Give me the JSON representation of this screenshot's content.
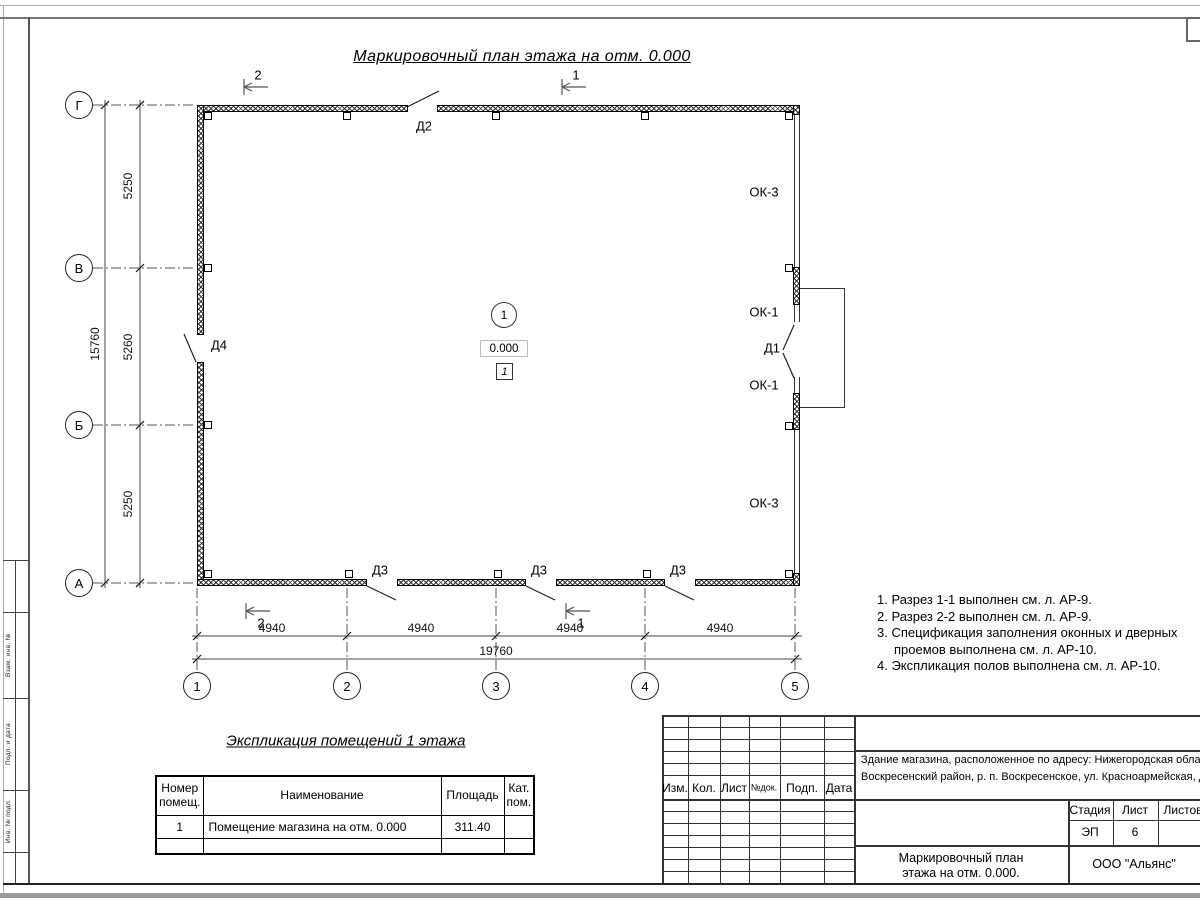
{
  "sheet": {
    "title": "Маркировочный план этажа на отм. 0.000"
  },
  "plan": {
    "axes_left": [
      {
        "label": "Г",
        "y": 105
      },
      {
        "label": "В",
        "y": 268
      },
      {
        "label": "Б",
        "y": 425
      },
      {
        "label": "А",
        "y": 583
      }
    ],
    "axes_bottom": [
      {
        "label": "1",
        "x": 197
      },
      {
        "label": "2",
        "x": 347
      },
      {
        "label": "3",
        "x": 496
      },
      {
        "label": "4",
        "x": 645
      },
      {
        "label": "5",
        "x": 795
      }
    ],
    "dims_left": [
      {
        "text": "5250",
        "y": 186
      },
      {
        "text": "5260",
        "y": 347
      },
      {
        "text": "5250",
        "y": 504
      }
    ],
    "dim_left_total": {
      "text": "15760",
      "y": 344
    },
    "dims_bottom": [
      {
        "text": "4940",
        "x": 272
      },
      {
        "text": "4940",
        "x": 421
      },
      {
        "text": "4940",
        "x": 570
      },
      {
        "text": "4940",
        "x": 720
      }
    ],
    "dim_bottom_total": {
      "text": "19760",
      "x": 496
    },
    "door_labels": [
      {
        "text": "Д2",
        "x": 424,
        "y": 126
      },
      {
        "text": "Д4",
        "x": 219,
        "y": 345
      },
      {
        "text": "Д1",
        "x": 772,
        "y": 348
      },
      {
        "text": "Д3",
        "x": 380,
        "y": 570
      },
      {
        "text": "Д3",
        "x": 539,
        "y": 570
      },
      {
        "text": "Д3",
        "x": 678,
        "y": 570
      }
    ],
    "window_labels": [
      {
        "text": "ОК-3",
        "x": 764,
        "y": 192
      },
      {
        "text": "ОК-1",
        "x": 764,
        "y": 312
      },
      {
        "text": "ОК-1",
        "x": 764,
        "y": 385
      },
      {
        "text": "ОК-3",
        "x": 764,
        "y": 503
      }
    ],
    "section_markers": [
      {
        "text": "2",
        "x": 244,
        "y": 87,
        "lx": 258,
        "ly": 75
      },
      {
        "text": "1",
        "x": 562,
        "y": 87,
        "lx": 576,
        "ly": 75
      },
      {
        "text": "2",
        "x": 246,
        "y": 611,
        "lx": 261,
        "ly": 623
      },
      {
        "text": "1",
        "x": 566,
        "y": 611,
        "lx": 581,
        "ly": 623
      }
    ],
    "room": {
      "number": "1",
      "elevation": "0.000",
      "floor_type": "1"
    }
  },
  "notes": {
    "items": [
      {
        "text": "1. Разрез 1-1 выполнен см. л. АР-9.",
        "indent": 0
      },
      {
        "text": "2. Разрез 2-2 выполнен см. л. АР-9.",
        "indent": 0
      },
      {
        "text": "3. Спецификация заполнения оконных и дверных",
        "indent": 0
      },
      {
        "text": "проемов выполнена см. л. АР-10.",
        "indent": 17
      },
      {
        "text": "4. Экспликация полов выполнена см. л. АР-10.",
        "indent": 0
      }
    ]
  },
  "explication": {
    "title": "Экспликация помещений 1 этажа",
    "headers": [
      "Номер помещ.",
      "Наименование",
      "Площадь",
      "Кат. пом."
    ],
    "rows": [
      [
        "1",
        "Помещение магазина на отм. 0.000",
        "311.40",
        ""
      ],
      [
        "",
        "",
        "",
        ""
      ]
    ]
  },
  "titleblock": {
    "header_cells": [
      "Изм.",
      "Кол.",
      "Лист",
      "№док.",
      "Подп.",
      "Дата"
    ],
    "project_line1": "Здание магазина, расположенное по адресу: Нижегородская область,",
    "project_line2": "Воскресенский район, р. п. Воскресенское, ул. Красноармейская, д. 1",
    "stage_label": "Стадия",
    "sheet_label": "Лист",
    "sheets_label": "Листов",
    "stage": "ЭП",
    "sheet_no": "6",
    "sheets": "",
    "doc_title_line1": "Маркировочный план",
    "doc_title_line2": "этажа на отм. 0.000.",
    "company": "ООО \"Альянс\""
  },
  "frame_left": {
    "labels": [
      {
        "text": "Взам. инв. №",
        "y": 655
      },
      {
        "text": "Подп. и дата",
        "y": 744
      },
      {
        "text": "Инв. № подл.",
        "y": 821
      }
    ]
  },
  "colors": {
    "line": "#333",
    "hatch": "#333",
    "frame_gray": "#888"
  }
}
